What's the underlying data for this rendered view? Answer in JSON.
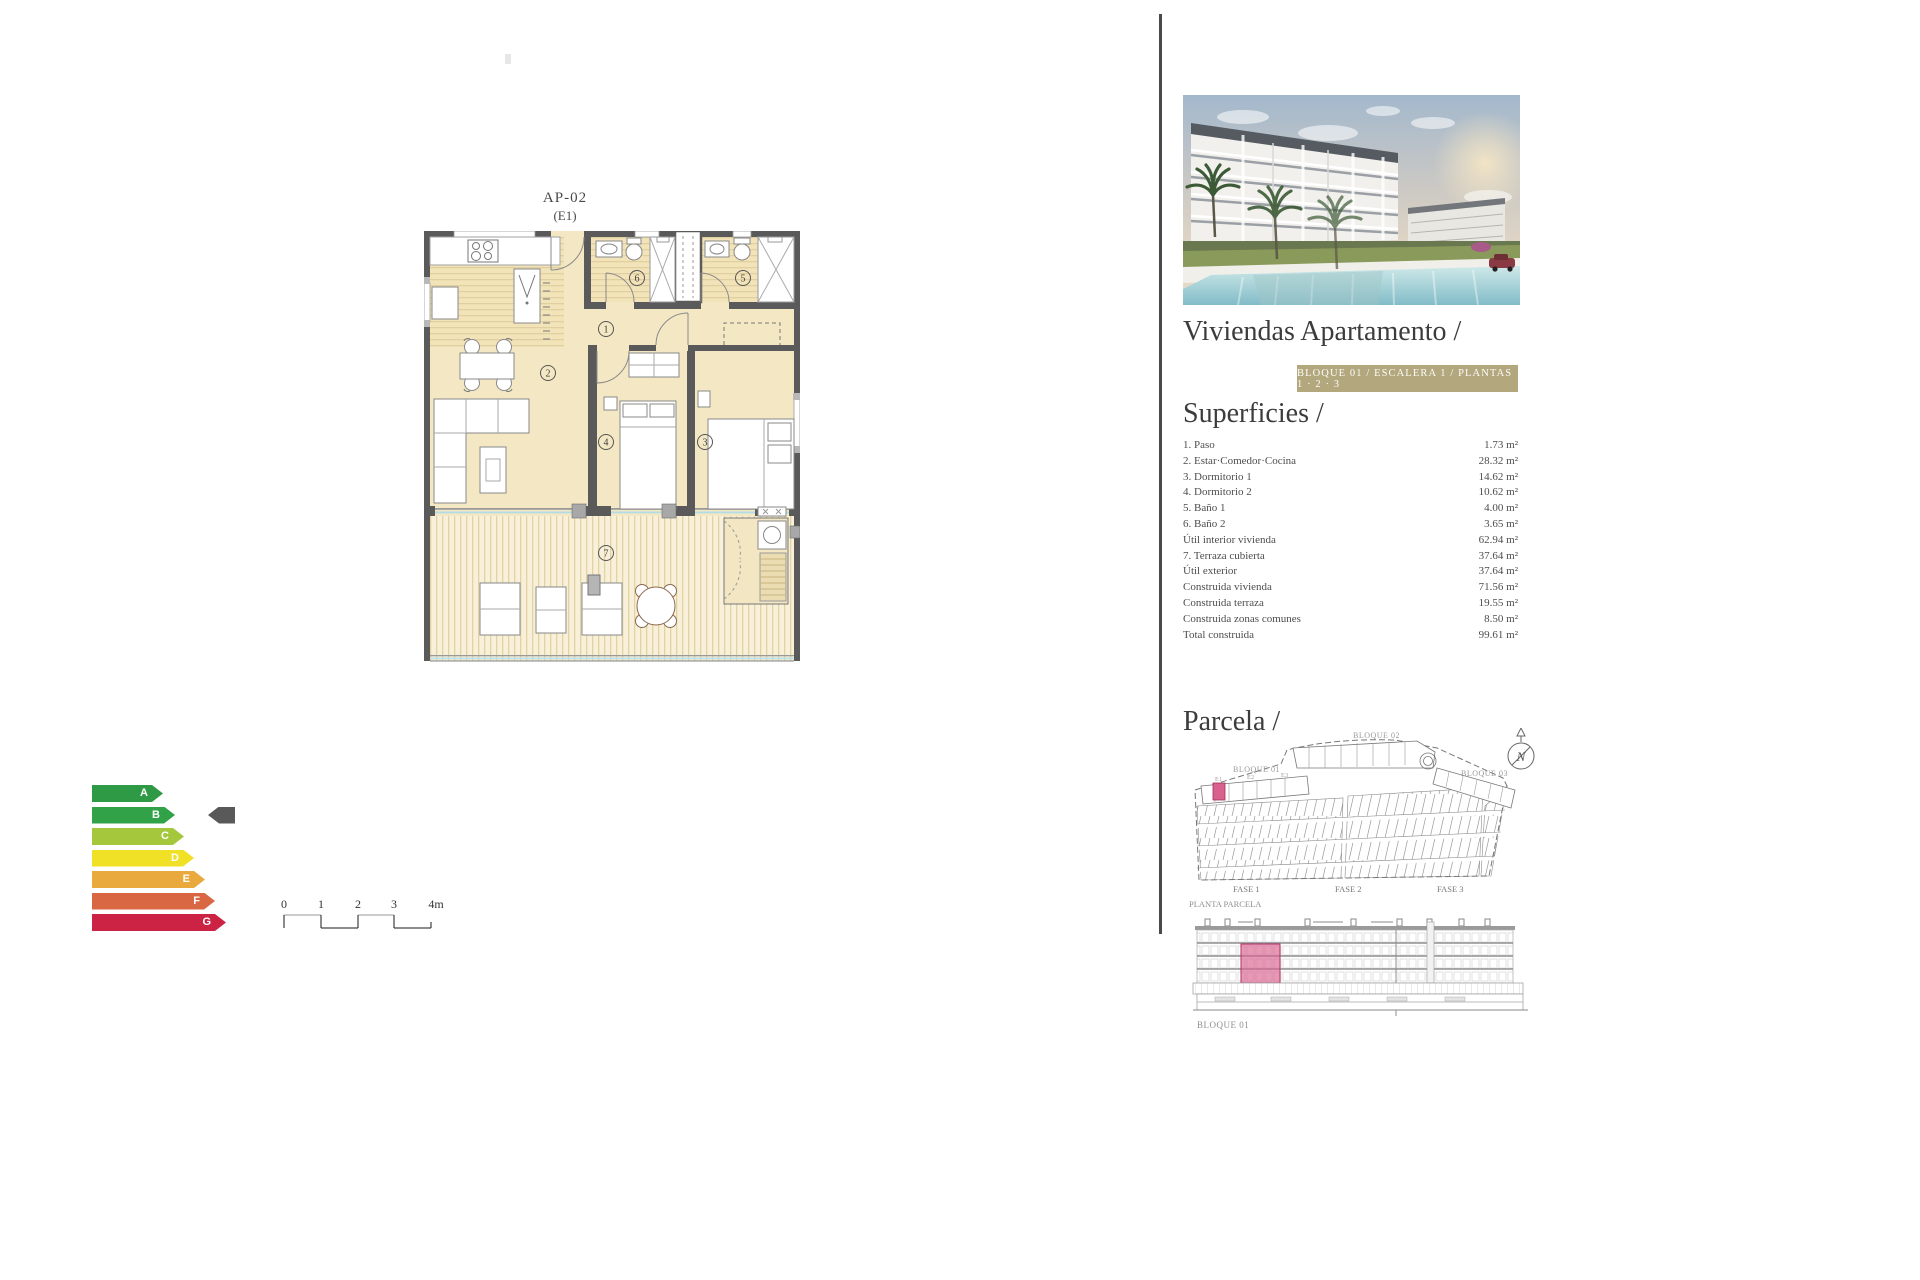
{
  "colors": {
    "badge_bg": "#b2a77d",
    "highlight_pink": "#d9618d",
    "indicator_gray": "#595959",
    "energy": {
      "A": "#2f9a46",
      "B": "#31a248",
      "C": "#a5c73c",
      "D": "#f0e126",
      "E": "#e9a93c",
      "F": "#da6743",
      "G": "#cc2244"
    }
  },
  "plan": {
    "code": "AP-02",
    "escalera": "(E1)",
    "rooms": [
      "1",
      "2",
      "3",
      "4",
      "5",
      "6",
      "7"
    ]
  },
  "energy_chart": {
    "ratings": [
      "A",
      "B",
      "C",
      "D",
      "E",
      "F",
      "G"
    ],
    "selected": "B"
  },
  "scale_bar": {
    "labels": [
      "0",
      "1",
      "2",
      "3",
      "4m"
    ]
  },
  "sidebar": {
    "title": "Viviendas Apartamento /",
    "badge": "BLOQUE 01 / ESCALERA 1 / PLANTAS 1 · 2 · 3",
    "superficies": {
      "heading": "Superficies /",
      "rows": [
        {
          "label": "1. Paso",
          "value": "1.73 m²"
        },
        {
          "label": "2. Estar·Comedor·Cocina",
          "value": "28.32 m²"
        },
        {
          "label": "3. Dormitorio 1",
          "value": "14.62 m²"
        },
        {
          "label": "4. Dormitorio 2",
          "value": "10.62 m²"
        },
        {
          "label": "5. Baño 1",
          "value": "4.00 m²"
        },
        {
          "label": "6. Baño 2",
          "value": "3.65 m²"
        },
        {
          "label": "Útil interior vivienda",
          "value": "62.94 m²"
        },
        {
          "label": "7. Terraza cubierta",
          "value": "37.64 m²"
        },
        {
          "label": "Útil exterior",
          "value": "37.64 m²"
        },
        {
          "label": "Construida vivienda",
          "value": "71.56 m²"
        },
        {
          "label": "Construida terraza",
          "value": "19.55 m²"
        },
        {
          "label": "Construida zonas comunes",
          "value": "8.50 m²"
        },
        {
          "label": "Total construida",
          "value": "99.61 m²"
        }
      ]
    },
    "parcela": {
      "heading": "Parcela /",
      "bloque1": "BLOQUE 01",
      "bloque2": "BLOQUE 02",
      "bloque3": "BLOQUE 03",
      "e1": "E1",
      "e2": "E2",
      "e3": "E3",
      "fase1": "FASE 1",
      "fase2": "FASE 2",
      "fase3": "FASE 3",
      "planta": "PLANTA PARCELA",
      "north": "N"
    },
    "elevation": {
      "label": "BLOQUE 01"
    }
  }
}
